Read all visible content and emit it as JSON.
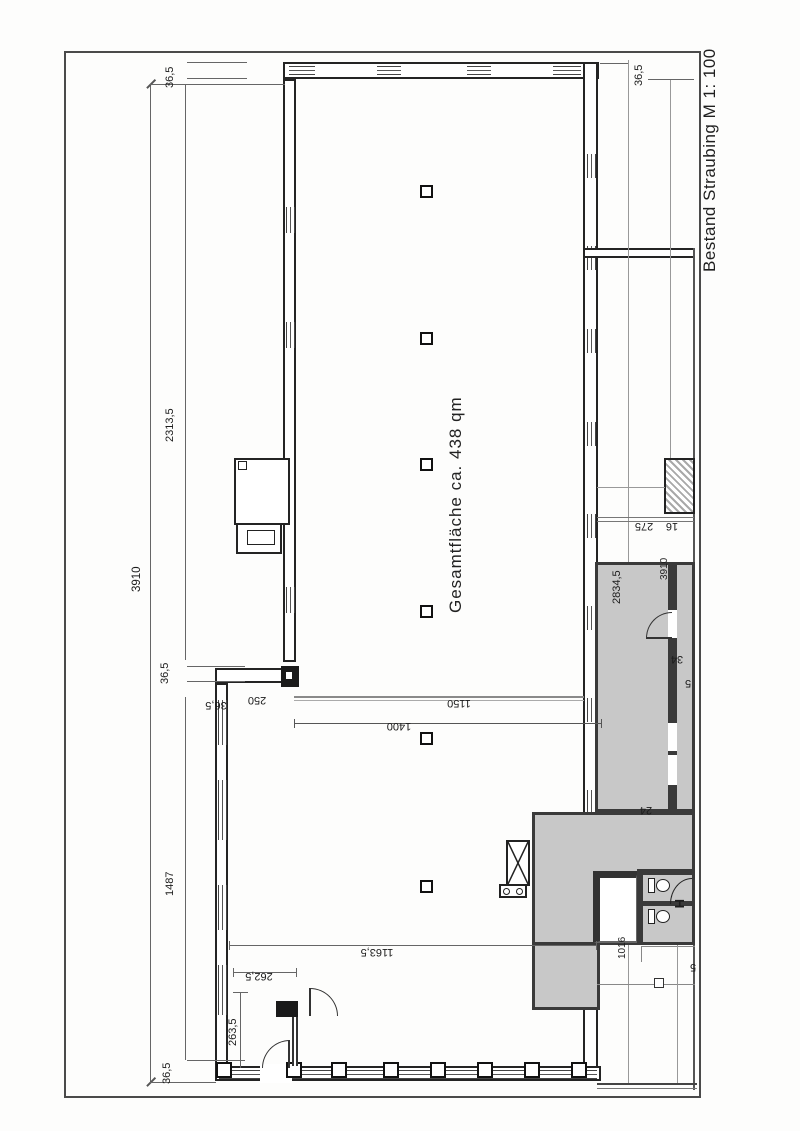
{
  "title": "Bestand Straubing M 1: 100",
  "plan": {
    "area_label": "Gesamtfläche ca. 438 qm",
    "dims": {
      "left_total": "3910",
      "left_wall_top": "36,5",
      "left_span_upper": "2313,5",
      "left_wall_mid": "36,5",
      "left_span_lower": "1487",
      "left_wall_bottom": "36,5",
      "step_wall": "36,5",
      "step_width": "250",
      "hall_width_upper": "1150",
      "hall_width_lower": "1400",
      "hall_width_bottom": "1163,5",
      "entry_width": "262,5",
      "entry_depth": "263,5",
      "right_wall_top": "36,5",
      "right_span": "2834,5",
      "right_width": "275",
      "right_wall": "16",
      "right_total": "3910",
      "door_34": "34",
      "door_5": "5",
      "door_24": "24",
      "room_1016": "1016",
      "edge_5": "5"
    },
    "symbols": {
      "wc_handle": "H"
    },
    "colors": {
      "room_fill": "#c8c8c8",
      "wall": "#242424",
      "dim_line": "#777777"
    }
  }
}
